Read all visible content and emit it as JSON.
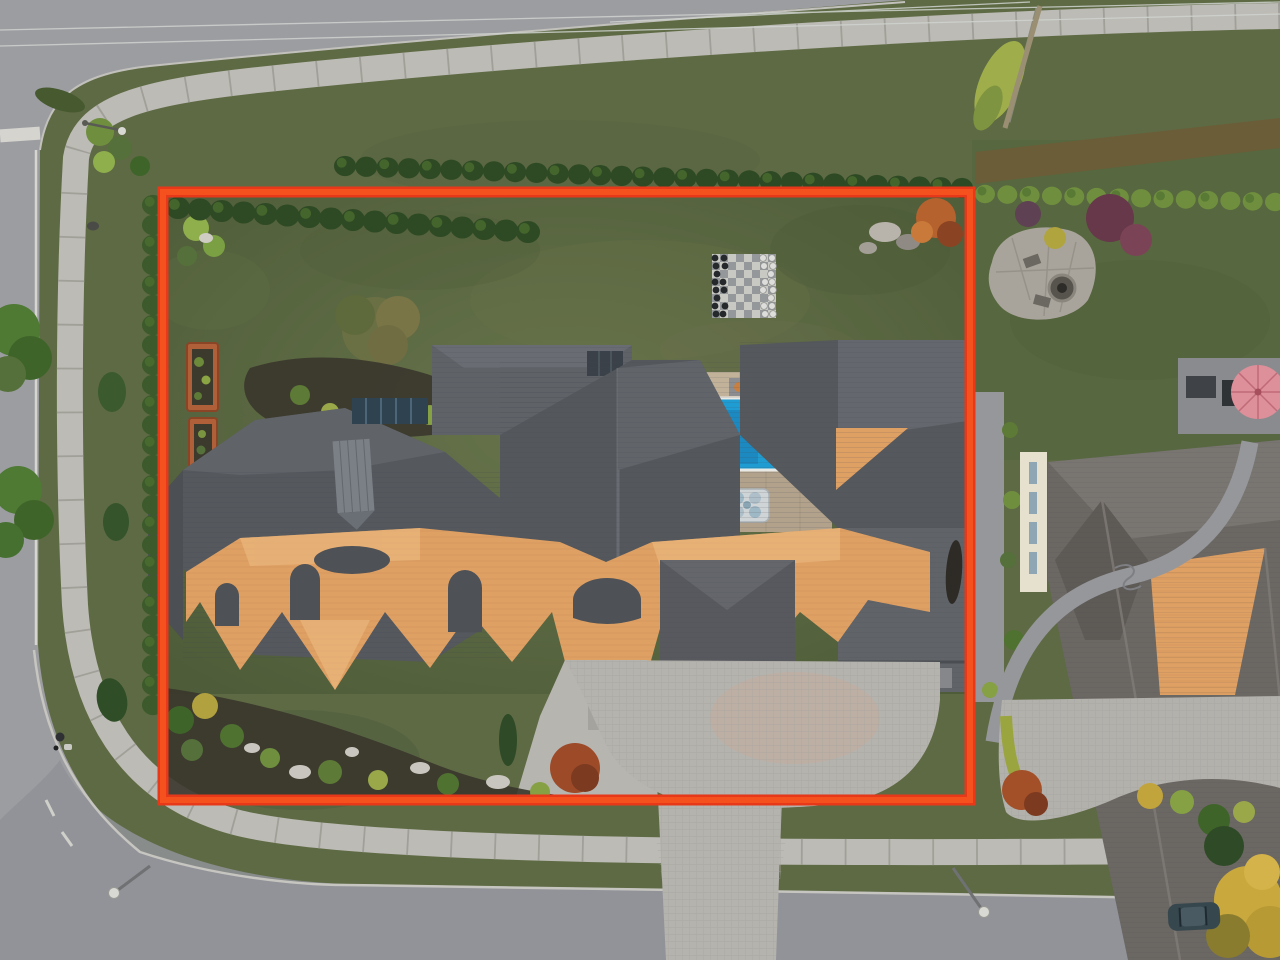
{
  "scene": {
    "type": "aerial-drone-photo",
    "subject": "luxury estate corner lot with red property-boundary overlay",
    "time_of_day": "sunset"
  },
  "colors": {
    "boundary": "#e8381a",
    "boundary_core": "#f4511e",
    "road": "#9c9da1",
    "road_bottom": "#8f9298",
    "sidewalk": "#bcbbb5",
    "sidewalk_joint": "#a09f98",
    "lawn": "#5e6a44",
    "backyard_lawn": "#5a6742",
    "front_lawn": "#4d5d3a",
    "neighbor_lawn": "#57673f",
    "hedge_dark": "#2e4a24",
    "hedge_light": "#6f8f3f",
    "cypress": "#3c5a2b",
    "roof_dark": "#55585d",
    "roof_mid": "#5f6267",
    "roof_light_facet": "#6b6e74",
    "roof_orange": "#dfa064",
    "roof_orange_light": "#edbd84",
    "roof_orange_shadow": "#b97f4a",
    "dormer_dark": "#4e5156",
    "pool_water": "#1f9cd2",
    "pool_water_light": "#45b6e2",
    "pool_steps": "#1b85bb",
    "pool_deck": "#b2a28c",
    "pool_deck_light": "#c2b29a",
    "driveway": "#b5b3ae",
    "driveway_warm": "#c4ab9c",
    "chess_light": "#c9c9c3",
    "chess_dark": "#94989a",
    "piece_black": "#26292c",
    "piece_white": "#dddddb",
    "planter": "#b06038",
    "planter_soil": "#3c3a2c",
    "umbrella": "#dd8f9a",
    "car": "#37474e",
    "neighbor_roof": "#6b6763",
    "neighbor_roof_light": "#7d7974",
    "cream_wall": "#e6e0cf",
    "soil": "#3a362c",
    "path_gray": "#96979b",
    "rock": "#c9c6bf",
    "skylight": "#2f4250",
    "solar_panel": "#3a4148",
    "autumn_tree": "#b5622e",
    "maroon_bush": "#67384a",
    "yellow_tree": "#c9a93e",
    "wire": "#cfd3cf"
  },
  "boundary_box": {
    "x": 163,
    "y": 192,
    "width": 807,
    "height": 608,
    "stroke_width": 9
  },
  "features": {
    "pool": {
      "x": 658,
      "y": 398,
      "width": 146,
      "height": 72
    },
    "chess_board": {
      "x": 712,
      "y": 254,
      "size": 64,
      "cells": 8,
      "black_files": [
        0,
        1
      ],
      "white_files": [
        6,
        7
      ],
      "black_counts": [
        8,
        6
      ],
      "white_counts": [
        6,
        8
      ]
    },
    "hedge_rows": [
      {
        "name": "left-cypress-hedge",
        "x1": 153,
        "y1": 205,
        "x2": 153,
        "y2": 705,
        "count": 26,
        "r": 11,
        "fill": "cypress"
      },
      {
        "name": "top-boundary-hedge",
        "x1": 345,
        "y1": 166,
        "x2": 962,
        "y2": 188,
        "count": 30,
        "r": 11,
        "fill": "hedge_dark"
      },
      {
        "name": "inner-top-hedge",
        "x1": 178,
        "y1": 208,
        "x2": 528,
        "y2": 232,
        "count": 17,
        "r": 12,
        "fill": "hedge_dark"
      },
      {
        "name": "neighbor-front-hedge",
        "x1": 985,
        "y1": 194,
        "x2": 1275,
        "y2": 202,
        "count": 14,
        "r": 10,
        "fill": "hedge_light"
      }
    ],
    "loungers": 2,
    "hot_tub": {
      "x": 727,
      "y": 489,
      "width": 42,
      "height": 33
    },
    "fire_pit": {
      "cx": 1062,
      "cy": 288,
      "r": 13
    },
    "garden_planters": 2,
    "street_lamps": 3,
    "pedestrian": {
      "x": 60,
      "y": 737
    },
    "parked_car": {
      "x": 1168,
      "y": 903
    }
  }
}
